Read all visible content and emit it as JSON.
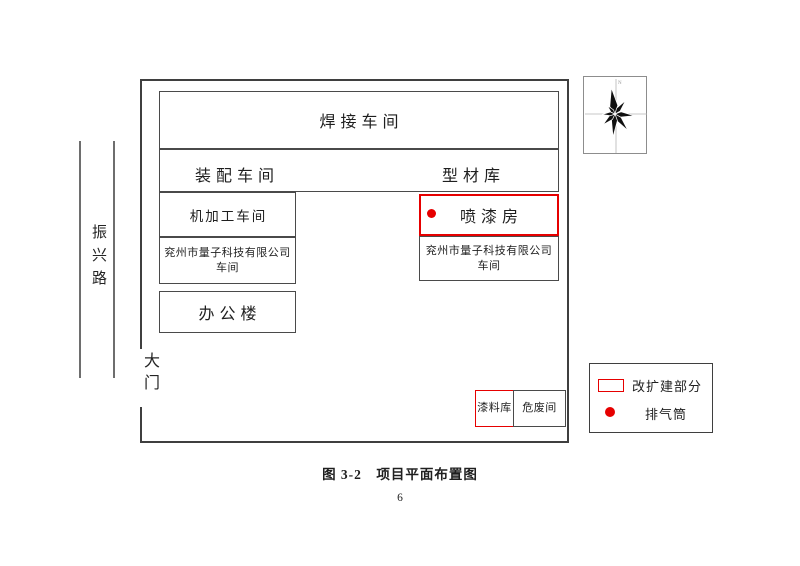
{
  "figure": {
    "caption": "图 3-2　项目平面布置图",
    "page_number": "6"
  },
  "surroundings": {
    "road_name": "振兴路",
    "gate_label": "大门"
  },
  "buildings": {
    "welding_workshop": "焊接车间",
    "assembly_workshop": "装配车间",
    "profile_warehouse": "型材库",
    "machining_workshop": "机加工车间",
    "company_workshop_left": {
      "line1": "兖州市量子科技有限公司",
      "line2": "车间"
    },
    "office_building": "办公楼",
    "spray_paint_room": "喷漆房",
    "company_workshop_right": {
      "line1": "兖州市量子科技有限公司",
      "line2": "车间"
    },
    "paint_material_store": "漆料库",
    "hazardous_waste_room": "危废间"
  },
  "legend": {
    "items": [
      {
        "symbol": "red-outline-rectangle",
        "label": "改扩建部分"
      },
      {
        "symbol": "red-filled-dot",
        "label": "排气筒"
      }
    ]
  },
  "colors": {
    "highlight_red": "#e60000",
    "line_gray": "#4a4a4a"
  }
}
